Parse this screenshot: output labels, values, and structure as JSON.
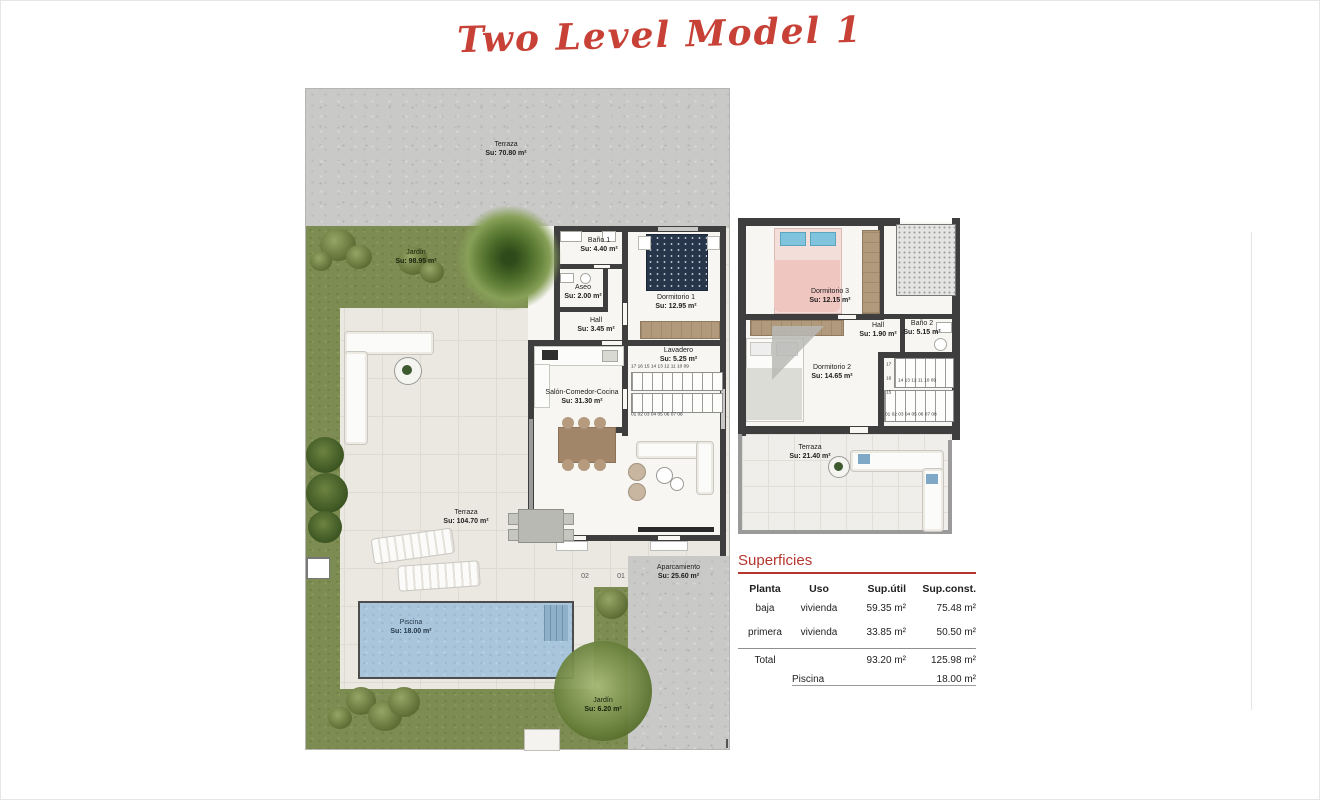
{
  "page": {
    "title": "Two Level Model 1"
  },
  "ground_floor": {
    "rooms": [
      {
        "name": "Terraza",
        "area": "Su: 70.80 m²"
      },
      {
        "name": "Jardín",
        "area": "Su: 98.95 m²"
      },
      {
        "name": "Baño 1",
        "area": "Su: 4.40 m²"
      },
      {
        "name": "Aseo",
        "area": "Su: 2.00 m²"
      },
      {
        "name": "Hall",
        "area": "Su: 3.45 m²"
      },
      {
        "name": "Dormitorio 1",
        "area": "Su: 12.95 m²"
      },
      {
        "name": "Lavadero",
        "area": "Su: 5.25 m²"
      },
      {
        "name": "Salón-Comedor-Cocina",
        "area": "Su: 31.30 m²"
      },
      {
        "name": "Terraza",
        "area": "Su: 104.70 m²"
      },
      {
        "name": "Piscina",
        "area": "Su: 18.00 m²"
      },
      {
        "name": "Aparcamiento",
        "area": "Su: 25.60 m²"
      },
      {
        "name": "Jardín",
        "area": "Su: 6.20 m²"
      }
    ],
    "stairs": {
      "top_row": "17 16 15 14 13 12 11 10 09",
      "bottom_row": "01 02 03 04 05 06 07 08"
    },
    "parking_spots": [
      "02",
      "01"
    ]
  },
  "first_floor": {
    "rooms": [
      {
        "name": "Dormitorio 3",
        "area": "Su: 12.15 m²"
      },
      {
        "name": "Hall",
        "area": "Su: 1.90 m²"
      },
      {
        "name": "Baño 2",
        "area": "Su: 5.15 m²"
      },
      {
        "name": "Dormitorio 2",
        "area": "Su: 14.65 m²"
      },
      {
        "name": "Terraza",
        "area": "Su: 21.40 m²"
      }
    ],
    "stairs": {
      "side": [
        "17",
        "16",
        "15"
      ],
      "mid_row": "14 13 12 11 10 09",
      "bottom_row": "01 02 03 04 05 06 07 08"
    }
  },
  "summary": {
    "title": "Superficies",
    "headers": [
      "Planta",
      "Uso",
      "Sup.útil",
      "Sup.const."
    ],
    "rows": [
      {
        "planta": "baja",
        "uso": "vivienda",
        "util": "59.35 m²",
        "const": "75.48 m²"
      },
      {
        "planta": "primera",
        "uso": "vivienda",
        "util": "33.85 m²",
        "const": "50.50 m²"
      }
    ],
    "total_label": "Total",
    "total_util": "93.20 m²",
    "total_const": "125.98 m²",
    "piscina_label": "Piscina",
    "piscina_value": "18.00 m²"
  },
  "colors": {
    "accent_red": "#b4362d",
    "wall": "#3e3e3e",
    "grass": "#7d8c52",
    "pool": "#a9c5db"
  }
}
